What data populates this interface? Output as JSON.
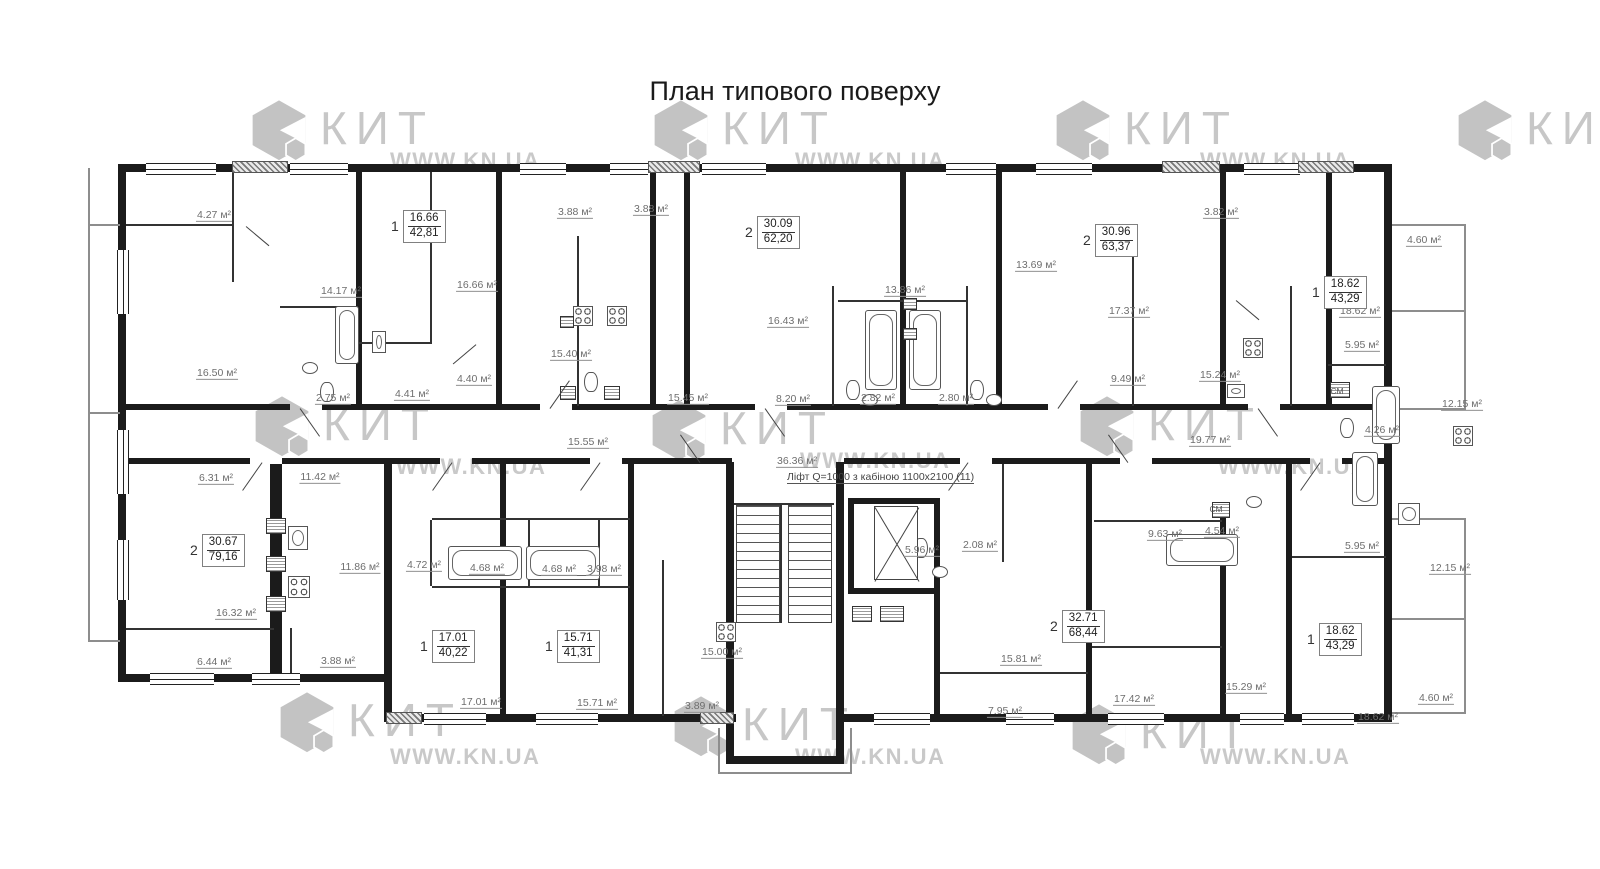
{
  "title": "План типового поверху",
  "lift_note": "Ліфт Q=1000 з кабіною 1100х2100  (11)",
  "brand_color": "#c7c7c7",
  "wall_color": "#1b1b1b",
  "watermarks": {
    "kit": [
      {
        "brand": "КИТ",
        "x": 250,
        "y": 96
      },
      {
        "brand": "КИТ",
        "x": 652,
        "y": 96
      },
      {
        "brand": "КИТ",
        "x": 1054,
        "y": 96
      },
      {
        "brand": "КИТ",
        "x": 1456,
        "y": 96
      },
      {
        "brand": "КИТ",
        "x": 253,
        "y": 392
      },
      {
        "brand": "КИТ",
        "x": 650,
        "y": 396
      },
      {
        "brand": "КИТ",
        "x": 1078,
        "y": 392
      },
      {
        "brand": "КИТ",
        "x": 278,
        "y": 688
      },
      {
        "brand": "КИТ",
        "x": 672,
        "y": 692
      },
      {
        "brand": "КИТ",
        "x": 1070,
        "y": 700
      }
    ],
    "site": [
      {
        "text": "WWW.KN.UA",
        "x": 390,
        "y": 148
      },
      {
        "text": "WWW.KN.UA",
        "x": 795,
        "y": 148
      },
      {
        "text": "WWW.KN.UA",
        "x": 1200,
        "y": 148
      },
      {
        "text": "WWW.KN.UA",
        "x": 396,
        "y": 454
      },
      {
        "text": "WWW.KN.UA",
        "x": 800,
        "y": 448
      },
      {
        "text": "WWW.KN.UA",
        "x": 1218,
        "y": 454
      },
      {
        "text": "WWW.KN.UA",
        "x": 390,
        "y": 744
      },
      {
        "text": "WWW.KN.UA",
        "x": 795,
        "y": 744
      },
      {
        "text": "WWW.KN.UA",
        "x": 1200,
        "y": 744
      }
    ]
  },
  "apartments": [
    {
      "rooms": "1",
      "living": "16.66",
      "total": "42,81",
      "x": 391,
      "y": 210
    },
    {
      "rooms": "2",
      "living": "30.09",
      "total": "62,20",
      "x": 745,
      "y": 216
    },
    {
      "rooms": "2",
      "living": "30.96",
      "total": "63,37",
      "x": 1083,
      "y": 224
    },
    {
      "rooms": "1",
      "living": "18.62",
      "total": "43,29",
      "x": 1312,
      "y": 276
    },
    {
      "rooms": "2",
      "living": "30.67",
      "total": "79,16",
      "x": 190,
      "y": 534
    },
    {
      "rooms": "1",
      "living": "17.01",
      "total": "40,22",
      "x": 420,
      "y": 630
    },
    {
      "rooms": "1",
      "living": "15.71",
      "total": "41,31",
      "x": 545,
      "y": 630
    },
    {
      "rooms": "2",
      "living": "32.71",
      "total": "68,44",
      "x": 1050,
      "y": 610
    },
    {
      "rooms": "1",
      "living": "18.62",
      "total": "43,29",
      "x": 1307,
      "y": 623
    }
  ],
  "room_labels": [
    {
      "text": "4.27 м²",
      "x": 214,
      "y": 216
    },
    {
      "text": "3.88 м²",
      "x": 575,
      "y": 213
    },
    {
      "text": "3.88 м²",
      "x": 651,
      "y": 210
    },
    {
      "text": "3.82 м²",
      "x": 1221,
      "y": 213
    },
    {
      "text": "4.60 м²",
      "x": 1424,
      "y": 241
    },
    {
      "text": "13.69 м²",
      "x": 1036,
      "y": 266
    },
    {
      "text": "14.17 м²",
      "x": 341,
      "y": 292
    },
    {
      "text": "16.66 м²",
      "x": 477,
      "y": 286
    },
    {
      "text": "13.86 м²",
      "x": 905,
      "y": 291
    },
    {
      "text": "18.62 м²",
      "x": 1360,
      "y": 312
    },
    {
      "text": "16.43 м²",
      "x": 788,
      "y": 322
    },
    {
      "text": "17.37 м²",
      "x": 1129,
      "y": 312
    },
    {
      "text": "5.95 м²",
      "x": 1362,
      "y": 346
    },
    {
      "text": "15.40 м²",
      "x": 571,
      "y": 355
    },
    {
      "text": "16.50 м²",
      "x": 217,
      "y": 374
    },
    {
      "text": "9.49 м²",
      "x": 1128,
      "y": 380
    },
    {
      "text": "15.24 м²",
      "x": 1220,
      "y": 376
    },
    {
      "text": "2.75 м²",
      "x": 333,
      "y": 399
    },
    {
      "text": "4.41 м²",
      "x": 412,
      "y": 395
    },
    {
      "text": "4.40 м²",
      "x": 474,
      "y": 380
    },
    {
      "text": "2.82 м²",
      "x": 878,
      "y": 399
    },
    {
      "text": "2.80 м²",
      "x": 956,
      "y": 399
    },
    {
      "text": "8.20 м²",
      "x": 793,
      "y": 400
    },
    {
      "text": "12.15 м²",
      "x": 1462,
      "y": 405
    },
    {
      "text": "15.45 м²",
      "x": 688,
      "y": 399
    },
    {
      "text": "15.55 м²",
      "x": 588,
      "y": 443
    },
    {
      "text": "4.26 м²",
      "x": 1382,
      "y": 431
    },
    {
      "text": "36.36 м²",
      "x": 797,
      "y": 462
    },
    {
      "text": "19.77 м²",
      "x": 1210,
      "y": 441
    },
    {
      "text": "6.31 м²",
      "x": 216,
      "y": 479
    },
    {
      "text": "11.42 м²",
      "x": 320,
      "y": 478
    },
    {
      "text": "11.86 м²",
      "x": 360,
      "y": 568
    },
    {
      "text": "4.72 м²",
      "x": 424,
      "y": 566
    },
    {
      "text": "4.68 м²",
      "x": 487,
      "y": 569
    },
    {
      "text": "4.68 м²",
      "x": 559,
      "y": 570
    },
    {
      "text": "3.98 м²",
      "x": 604,
      "y": 570
    },
    {
      "text": "5.96 м²",
      "x": 922,
      "y": 551
    },
    {
      "text": "2.08 м²",
      "x": 980,
      "y": 546
    },
    {
      "text": "9.63 м²",
      "x": 1165,
      "y": 535
    },
    {
      "text": "4.54 м²",
      "x": 1222,
      "y": 532
    },
    {
      "text": "5.95 м²",
      "x": 1362,
      "y": 547
    },
    {
      "text": "12.15 м²",
      "x": 1450,
      "y": 569
    },
    {
      "text": "16.32 м²",
      "x": 236,
      "y": 614
    },
    {
      "text": "6.44 м²",
      "x": 214,
      "y": 663
    },
    {
      "text": "3.88 м²",
      "x": 338,
      "y": 662
    },
    {
      "text": "15.00 м²",
      "x": 722,
      "y": 653
    },
    {
      "text": "15.81 м²",
      "x": 1021,
      "y": 660
    },
    {
      "text": "17.01 м²",
      "x": 481,
      "y": 703
    },
    {
      "text": "15.71 м²",
      "x": 597,
      "y": 704
    },
    {
      "text": "3.89 м²",
      "x": 702,
      "y": 707
    },
    {
      "text": "7.95 м²",
      "x": 1005,
      "y": 712
    },
    {
      "text": "17.42 м²",
      "x": 1134,
      "y": 700
    },
    {
      "text": "15.29 м²",
      "x": 1246,
      "y": 688
    },
    {
      "text": "18.62 м²",
      "x": 1378,
      "y": 718
    },
    {
      "text": "4.60 м²",
      "x": 1436,
      "y": 699
    }
  ],
  "fixture_labels": [
    {
      "text": "СМ",
      "x": 1337,
      "y": 391
    },
    {
      "text": "СМ",
      "x": 1216,
      "y": 509
    }
  ]
}
